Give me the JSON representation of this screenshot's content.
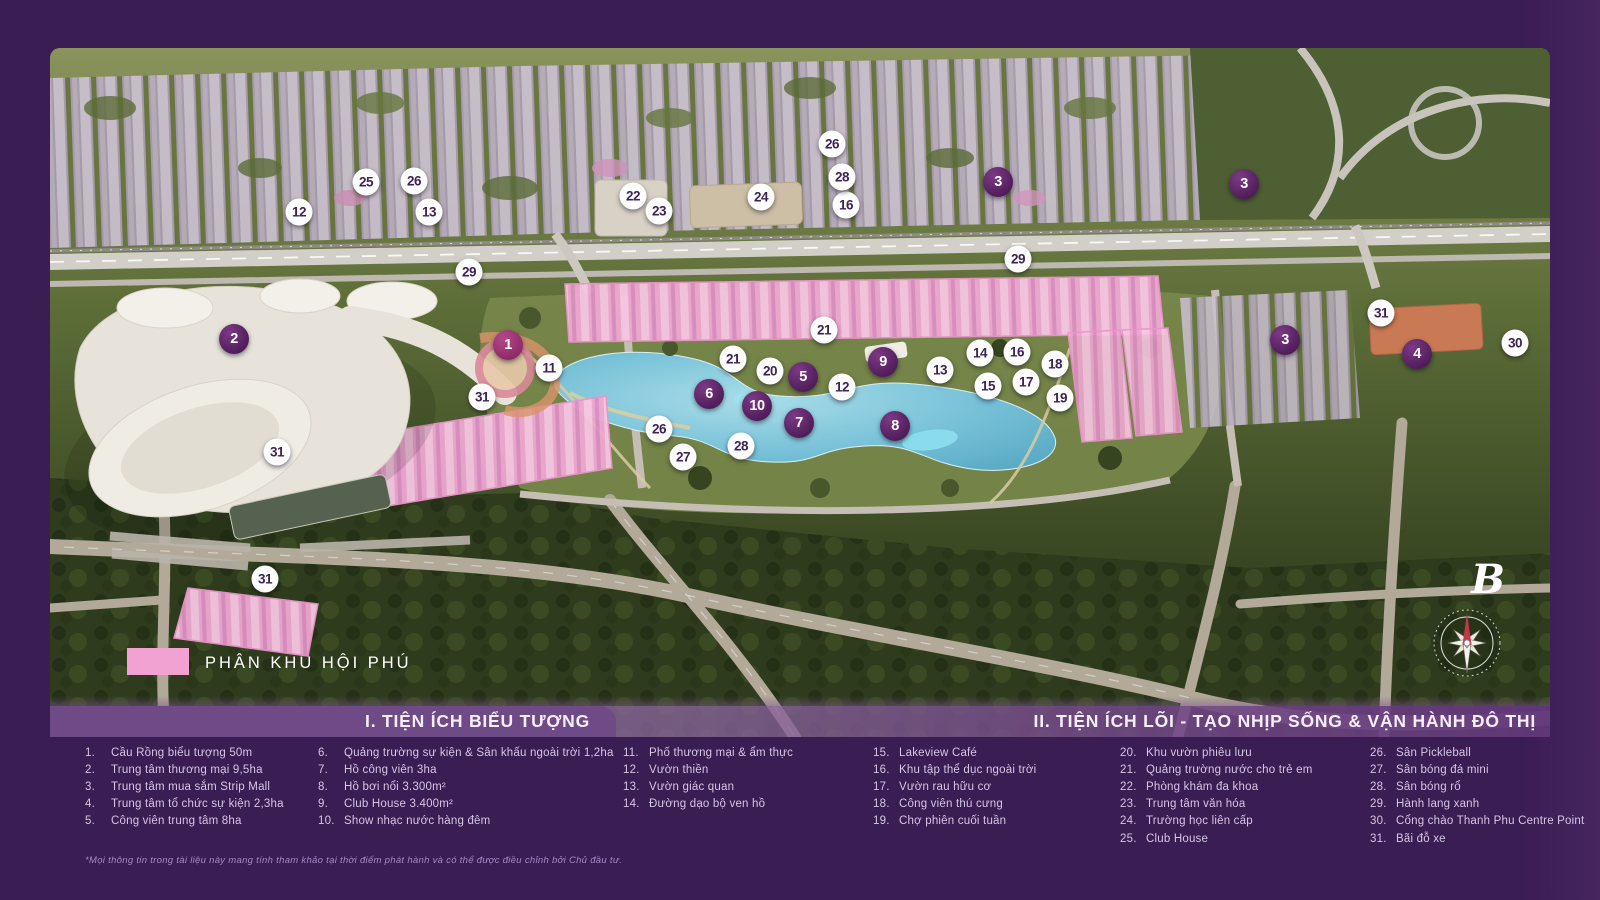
{
  "map": {
    "region_label": "PHÂN KHU HỘI PHÚ",
    "north_label": "B",
    "markers": [
      {
        "n": "2",
        "x": 184,
        "y": 291,
        "t": "p"
      },
      {
        "n": "1",
        "x": 458,
        "y": 297,
        "t": "a"
      },
      {
        "n": "3",
        "x": 948,
        "y": 134,
        "t": "p"
      },
      {
        "n": "3",
        "x": 1194,
        "y": 136,
        "t": "p"
      },
      {
        "n": "3",
        "x": 1235,
        "y": 292,
        "t": "p"
      },
      {
        "n": "4",
        "x": 1367,
        "y": 306,
        "t": "p"
      },
      {
        "n": "5",
        "x": 753,
        "y": 329,
        "t": "p"
      },
      {
        "n": "6",
        "x": 659,
        "y": 346,
        "t": "p"
      },
      {
        "n": "7",
        "x": 749,
        "y": 375,
        "t": "p"
      },
      {
        "n": "8",
        "x": 845,
        "y": 378,
        "t": "p"
      },
      {
        "n": "9",
        "x": 833,
        "y": 314,
        "t": "p"
      },
      {
        "n": "10",
        "x": 707,
        "y": 358,
        "t": "p"
      },
      {
        "n": "11",
        "x": 499,
        "y": 320,
        "t": "w"
      },
      {
        "n": "12",
        "x": 249,
        "y": 164,
        "t": "w"
      },
      {
        "n": "12",
        "x": 792,
        "y": 339,
        "t": "w"
      },
      {
        "n": "13",
        "x": 379,
        "y": 164,
        "t": "w"
      },
      {
        "n": "13",
        "x": 890,
        "y": 322,
        "t": "w"
      },
      {
        "n": "14",
        "x": 930,
        "y": 305,
        "t": "w"
      },
      {
        "n": "15",
        "x": 938,
        "y": 338,
        "t": "w"
      },
      {
        "n": "16",
        "x": 796,
        "y": 157,
        "t": "w"
      },
      {
        "n": "16",
        "x": 967,
        "y": 304,
        "t": "w"
      },
      {
        "n": "17",
        "x": 976,
        "y": 334,
        "t": "w"
      },
      {
        "n": "18",
        "x": 1005,
        "y": 316,
        "t": "w"
      },
      {
        "n": "19",
        "x": 1010,
        "y": 350,
        "t": "w"
      },
      {
        "n": "20",
        "x": 720,
        "y": 323,
        "t": "w"
      },
      {
        "n": "21",
        "x": 774,
        "y": 282,
        "t": "w"
      },
      {
        "n": "21",
        "x": 683,
        "y": 311,
        "t": "w"
      },
      {
        "n": "22",
        "x": 583,
        "y": 148,
        "t": "w"
      },
      {
        "n": "23",
        "x": 609,
        "y": 163,
        "t": "w"
      },
      {
        "n": "24",
        "x": 711,
        "y": 149,
        "t": "w"
      },
      {
        "n": "25",
        "x": 316,
        "y": 134,
        "t": "w"
      },
      {
        "n": "26",
        "x": 364,
        "y": 133,
        "t": "w"
      },
      {
        "n": "26",
        "x": 782,
        "y": 96,
        "t": "w"
      },
      {
        "n": "26",
        "x": 609,
        "y": 381,
        "t": "w"
      },
      {
        "n": "27",
        "x": 633,
        "y": 409,
        "t": "w"
      },
      {
        "n": "28",
        "x": 792,
        "y": 129,
        "t": "w"
      },
      {
        "n": "28",
        "x": 691,
        "y": 398,
        "t": "w"
      },
      {
        "n": "29",
        "x": 419,
        "y": 224,
        "t": "w"
      },
      {
        "n": "29",
        "x": 968,
        "y": 211,
        "t": "w"
      },
      {
        "n": "30",
        "x": 1465,
        "y": 295,
        "t": "w"
      },
      {
        "n": "31",
        "x": 432,
        "y": 349,
        "t": "w"
      },
      {
        "n": "31",
        "x": 227,
        "y": 404,
        "t": "w"
      },
      {
        "n": "31",
        "x": 215,
        "y": 531,
        "t": "w"
      },
      {
        "n": "31",
        "x": 1331,
        "y": 265,
        "t": "w"
      }
    ]
  },
  "legend": {
    "section1_title": "I. TIỆN ÍCH BIỂU TƯỢNG",
    "section2_title": "II. TIỆN ÍCH LÕI - TẠO NHỊP SỐNG & VẬN HÀNH ĐÔ THỊ",
    "columns": [
      [
        {
          "n": "1.",
          "label": "Cầu Rồng biểu tượng 50m"
        },
        {
          "n": "2.",
          "label": "Trung tâm thương mại 9,5ha"
        },
        {
          "n": "3.",
          "label": "Trung tâm mua sắm Strip Mall"
        },
        {
          "n": "4.",
          "label": "Trung tâm tổ chức sự kiện 2,3ha"
        },
        {
          "n": "5.",
          "label": "Công viên trung tâm 8ha"
        }
      ],
      [
        {
          "n": "6.",
          "label": "Quảng trường sự kiện & Sân khấu ngoài trời 1,2ha"
        },
        {
          "n": "7.",
          "label": "Hồ công viên 3ha"
        },
        {
          "n": "8.",
          "label": "Hồ bơi nổi 3.300m²"
        },
        {
          "n": "9.",
          "label": "Club House 3.400m²"
        },
        {
          "n": "10.",
          "label": "Show nhạc nước hàng đêm"
        }
      ],
      [
        {
          "n": "11.",
          "label": "Phố thương mại & ẩm thực"
        },
        {
          "n": "12.",
          "label": "Vườn thiền"
        },
        {
          "n": "13.",
          "label": "Vườn giác quan"
        },
        {
          "n": "14.",
          "label": "Đường dạo bộ ven hồ"
        }
      ],
      [
        {
          "n": "15.",
          "label": "Lakeview Café"
        },
        {
          "n": "16.",
          "label": "Khu tập thể dục ngoài trời"
        },
        {
          "n": "17.",
          "label": "Vườn rau hữu cơ"
        },
        {
          "n": "18.",
          "label": "Công viên thú cưng"
        },
        {
          "n": "19.",
          "label": "Chợ phiên cuối tuần"
        }
      ],
      [
        {
          "n": "20.",
          "label": "Khu vườn phiêu lưu"
        },
        {
          "n": "21.",
          "label": "Quảng trường nước cho trẻ em"
        },
        {
          "n": "22.",
          "label": "Phòng khám đa khoa"
        },
        {
          "n": "23.",
          "label": "Trung tâm văn hóa"
        },
        {
          "n": "24.",
          "label": "Trường học liên cấp"
        },
        {
          "n": "25.",
          "label": "Club House"
        }
      ],
      [
        {
          "n": "26.",
          "label": "Sân Pickleball"
        },
        {
          "n": "27.",
          "label": "Sân bóng đá mini"
        },
        {
          "n": "28.",
          "label": "Sân bóng rổ"
        },
        {
          "n": "29.",
          "label": "Hành lang xanh"
        },
        {
          "n": "30.",
          "label": "Cổng chào Thanh Phu Centre Point"
        },
        {
          "n": "31.",
          "label": "Bãi đỗ xe"
        }
      ]
    ],
    "footnote": "*Mọi thông tin trong tài liệu này mang tính tham khảo tại thời điểm phát hành và có thể được điều chỉnh bởi Chủ đầu tư."
  },
  "colors": {
    "highlight_pink": "#f2a6d2",
    "frame_purple": "#3a1d53",
    "marker_purple": "#4e1c58",
    "water_blue": "#5fb0cd"
  }
}
